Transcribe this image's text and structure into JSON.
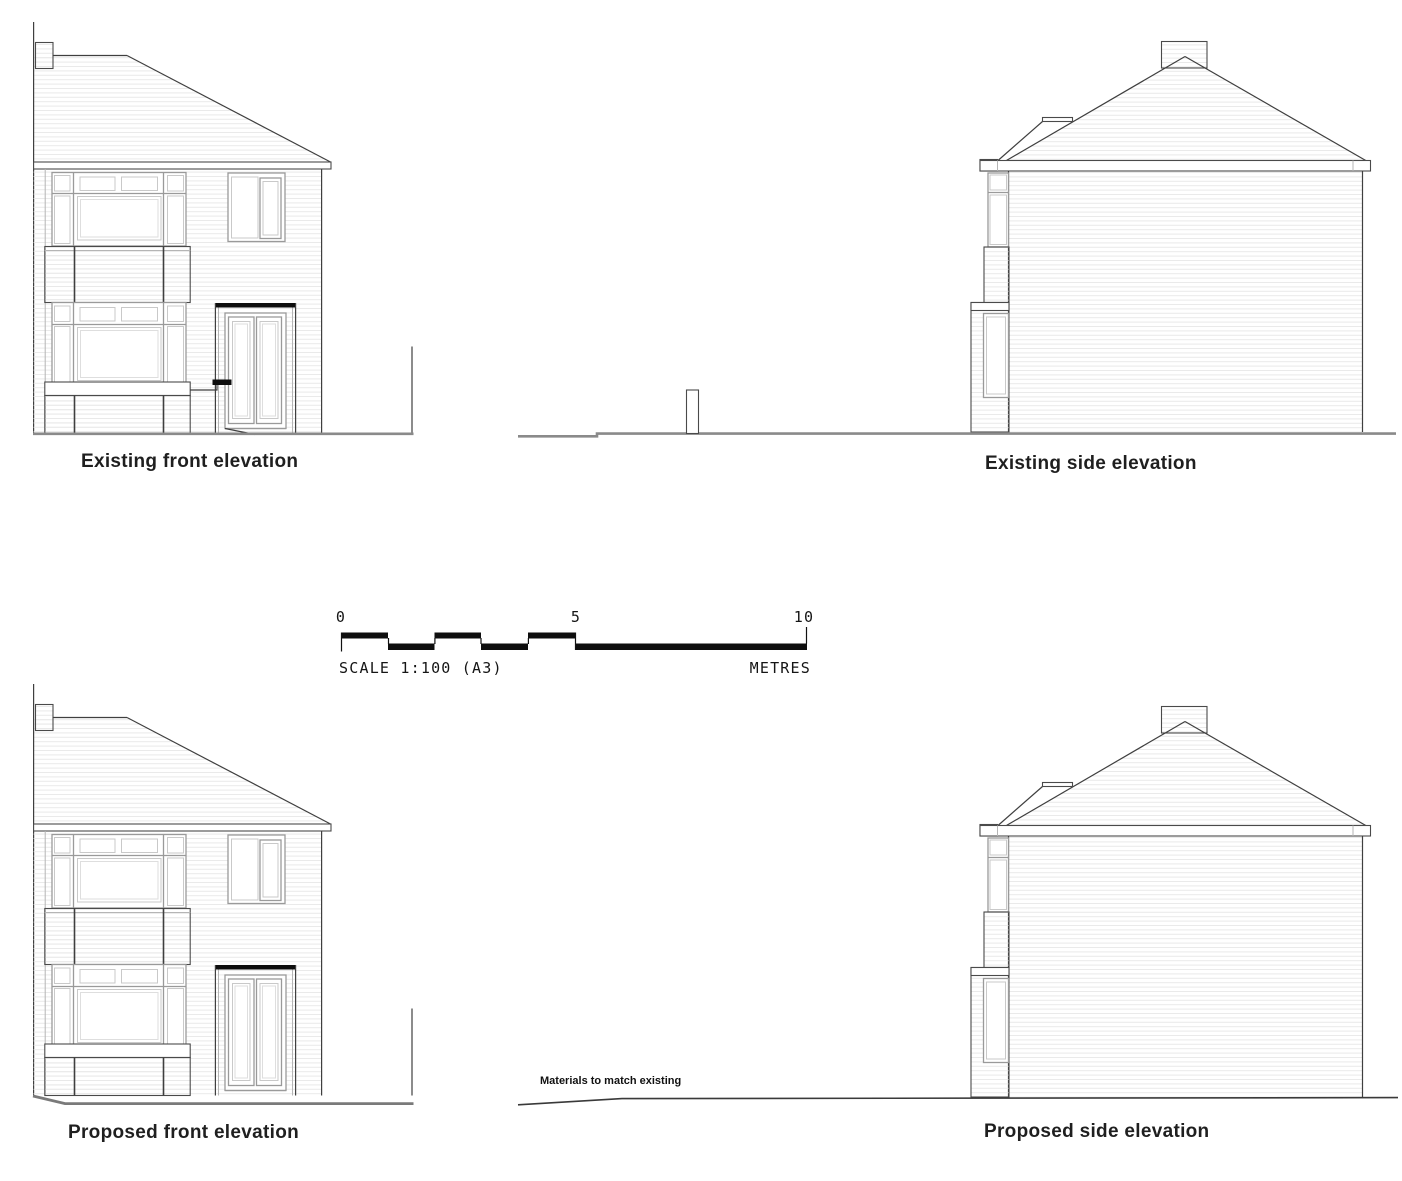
{
  "elevations": {
    "existing_front": {
      "label": "Existing front elevation"
    },
    "existing_side": {
      "label": "Existing side elevation"
    },
    "proposed_front": {
      "label": "Proposed front elevation"
    },
    "proposed_side": {
      "label": "Proposed side elevation"
    }
  },
  "scale_bar": {
    "tick_labels": [
      "0",
      "5",
      "10"
    ],
    "scale_text": "SCALE 1:100 (A3)",
    "units_label": "METRES"
  },
  "notes": {
    "materials_note": "Materials to match existing"
  },
  "colors": {
    "line_dark": "#3f3f3f",
    "frame_gray": "#9a9a9a",
    "pane_gray": "#c9c9c9",
    "hatch_gray": "#e9e9e9",
    "ground_gray": "#8a8a8a",
    "bar_black": "#0e0e0e",
    "text_black": "#1f1f1f"
  }
}
